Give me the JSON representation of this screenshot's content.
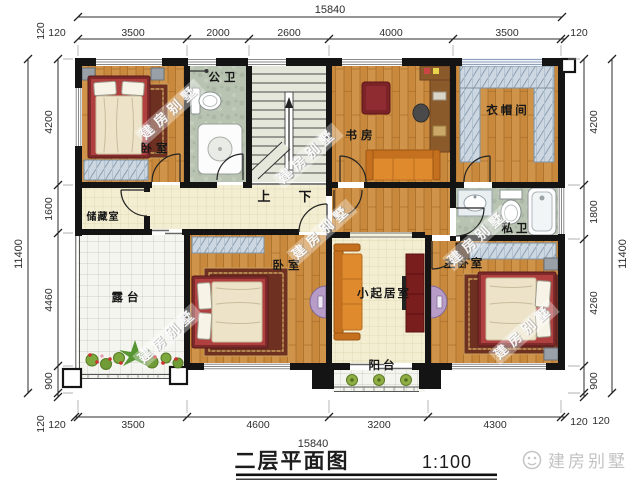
{
  "meta": {
    "caption": "二层平面图",
    "scale_label": "1:100",
    "brand": "建房别墅",
    "watermark": "建房别墅"
  },
  "rooms": {
    "bedroom1": "卧室",
    "public_bath": "公卫",
    "study": "书房",
    "cloakroom": "衣帽间",
    "storage": "储藏室",
    "private_bath": "私卫",
    "bedroom2": "卧室",
    "master_bedroom": "主卧室",
    "living_room": "小起居室",
    "terrace": "露台",
    "balcony": "阳台",
    "stair_up": "上",
    "stair_down": "下"
  },
  "dims": {
    "top": {
      "overall": "15840",
      "end_left": "120",
      "end_right": "120",
      "segments": [
        "3500",
        "2000",
        "2600",
        "4000",
        "3500"
      ]
    },
    "bottom": {
      "overall": "15840",
      "end_left": "120",
      "end_right": "120",
      "segments": [
        "3500",
        "4600",
        "3200",
        "4300"
      ]
    },
    "left": {
      "overall": "11400",
      "end_top": "120",
      "end_bottom": "120",
      "segments": [
        "4200",
        "1600",
        "4460",
        "900"
      ]
    },
    "right": {
      "overall": "11400",
      "end_bottom": "120",
      "segments": [
        "4200",
        "1800",
        "4260",
        "900"
      ]
    }
  },
  "colors": {
    "wall": "#141414",
    "wood": "#c8893c",
    "tile_cream": "#f3eed2",
    "tile_white": "#f5f5ef",
    "marble": "#b9c3b2",
    "sofa_orange": "#e08a2e",
    "bed_frame_red": "#7e2a2a",
    "wardrobe_blue": "#ccd7e2",
    "console_purple": "#b89cc8",
    "logo_gray": "#c3c3c3"
  }
}
